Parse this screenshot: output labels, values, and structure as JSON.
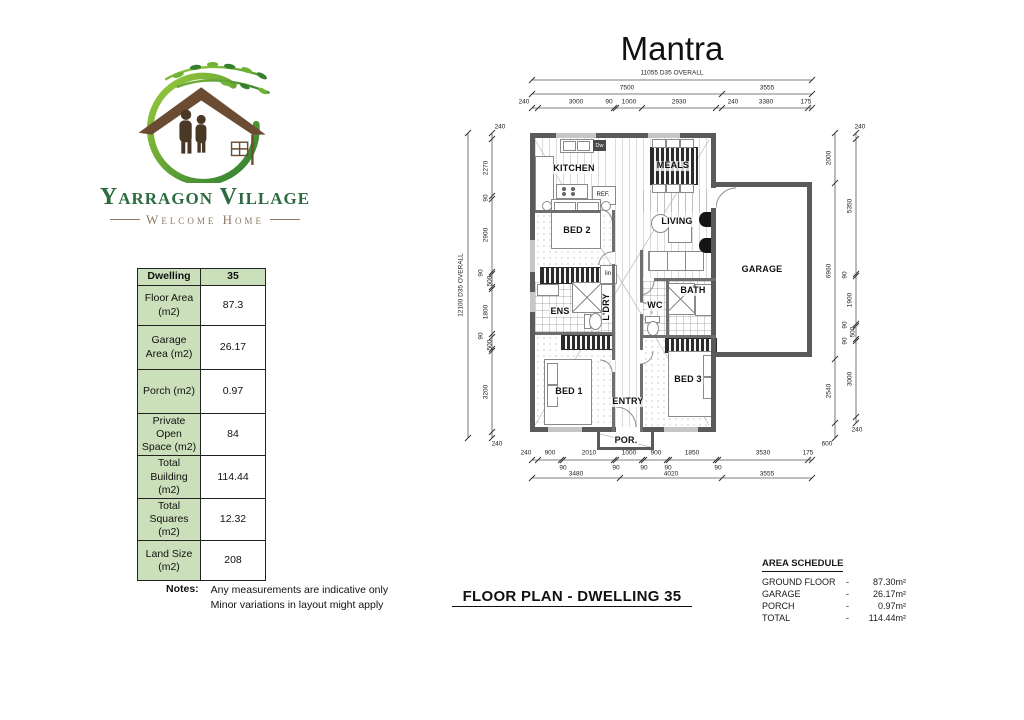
{
  "colors": {
    "table_green": "#cbdfba",
    "logo_green": "#2c6b3f",
    "logo_leaf_green": "#6fb234",
    "logo_brown": "#6b4c33",
    "tagline_brown": "#8c7a64",
    "wall_gray": "#5a5a5a"
  },
  "logo": {
    "title": "Yarragon Village",
    "tagline": "Welcome Home"
  },
  "plan": {
    "title": "Mantra",
    "footer_title": "FLOOR PLAN - DWELLING 35",
    "rooms": {
      "kitchen": "KITCHEN",
      "meals": "MEALS",
      "living": "LIVING",
      "bed2": "BED 2",
      "bed1": "BED 1",
      "bed3": "BED 3",
      "ens": "ENS",
      "laundry": "L'DRY",
      "wc": "WC",
      "bath": "BATH",
      "entry": "ENTRY",
      "porch": "POR.",
      "garage": "GARAGE"
    },
    "fixtures": {
      "fridge": "REF.",
      "dishwasher": "Dw",
      "linen": "lin"
    },
    "dims": {
      "top_overall": "11055 D35 OVERALL",
      "top_row2": [
        "7500",
        "3555"
      ],
      "top_row3": [
        "240",
        "3000",
        "90",
        "1000",
        "2930",
        "240",
        "3380",
        "175"
      ],
      "bottom_row1": [
        "240",
        "900",
        "2010",
        "1000",
        "900",
        "1850",
        "3530",
        "175"
      ],
      "bottom_row1_90s": [
        "90",
        "90",
        "90",
        "90",
        "90"
      ],
      "bottom_row2": [
        "3480",
        "4020",
        "3555"
      ],
      "left_overall": "12100 D35 OVERALL",
      "left_col": [
        "240",
        "2270",
        "90",
        "2900",
        "90",
        "500",
        "1800",
        "90",
        "500",
        "3200",
        "240"
      ],
      "right_outer": [
        "2000",
        "6960",
        "2540",
        "600"
      ],
      "right_inner": [
        "240",
        "5350",
        "90",
        "1900",
        "90",
        "500",
        "90",
        "3000",
        "240"
      ]
    }
  },
  "spec_table": {
    "header": {
      "label": "Dwelling",
      "value": "35"
    },
    "rows": [
      {
        "label": "Floor Area (m2)",
        "value": "87.3"
      },
      {
        "label": "Garage Area (m2)",
        "value": "26.17"
      },
      {
        "label": "Porch (m2)",
        "value": "0.97"
      },
      {
        "label": "Private Open Space (m2)",
        "value": "84"
      },
      {
        "label": "Total Building (m2)",
        "value": "114.44"
      },
      {
        "label": "Total Squares (m2)",
        "value": "12.32"
      },
      {
        "label": "Land Size (m2)",
        "value": "208"
      }
    ]
  },
  "notes": {
    "heading": "Notes:",
    "lines": [
      "Any measurements are indicative only",
      "Minor variations in layout might apply"
    ]
  },
  "area_schedule": {
    "title": "AREA SCHEDULE",
    "rows": [
      {
        "label": "GROUND FLOOR",
        "value": "87.30m²"
      },
      {
        "label": "GARAGE",
        "value": "26.17m²"
      },
      {
        "label": "PORCH",
        "value": "0.97m²"
      },
      {
        "label": "TOTAL",
        "value": "114.44m²"
      }
    ]
  }
}
